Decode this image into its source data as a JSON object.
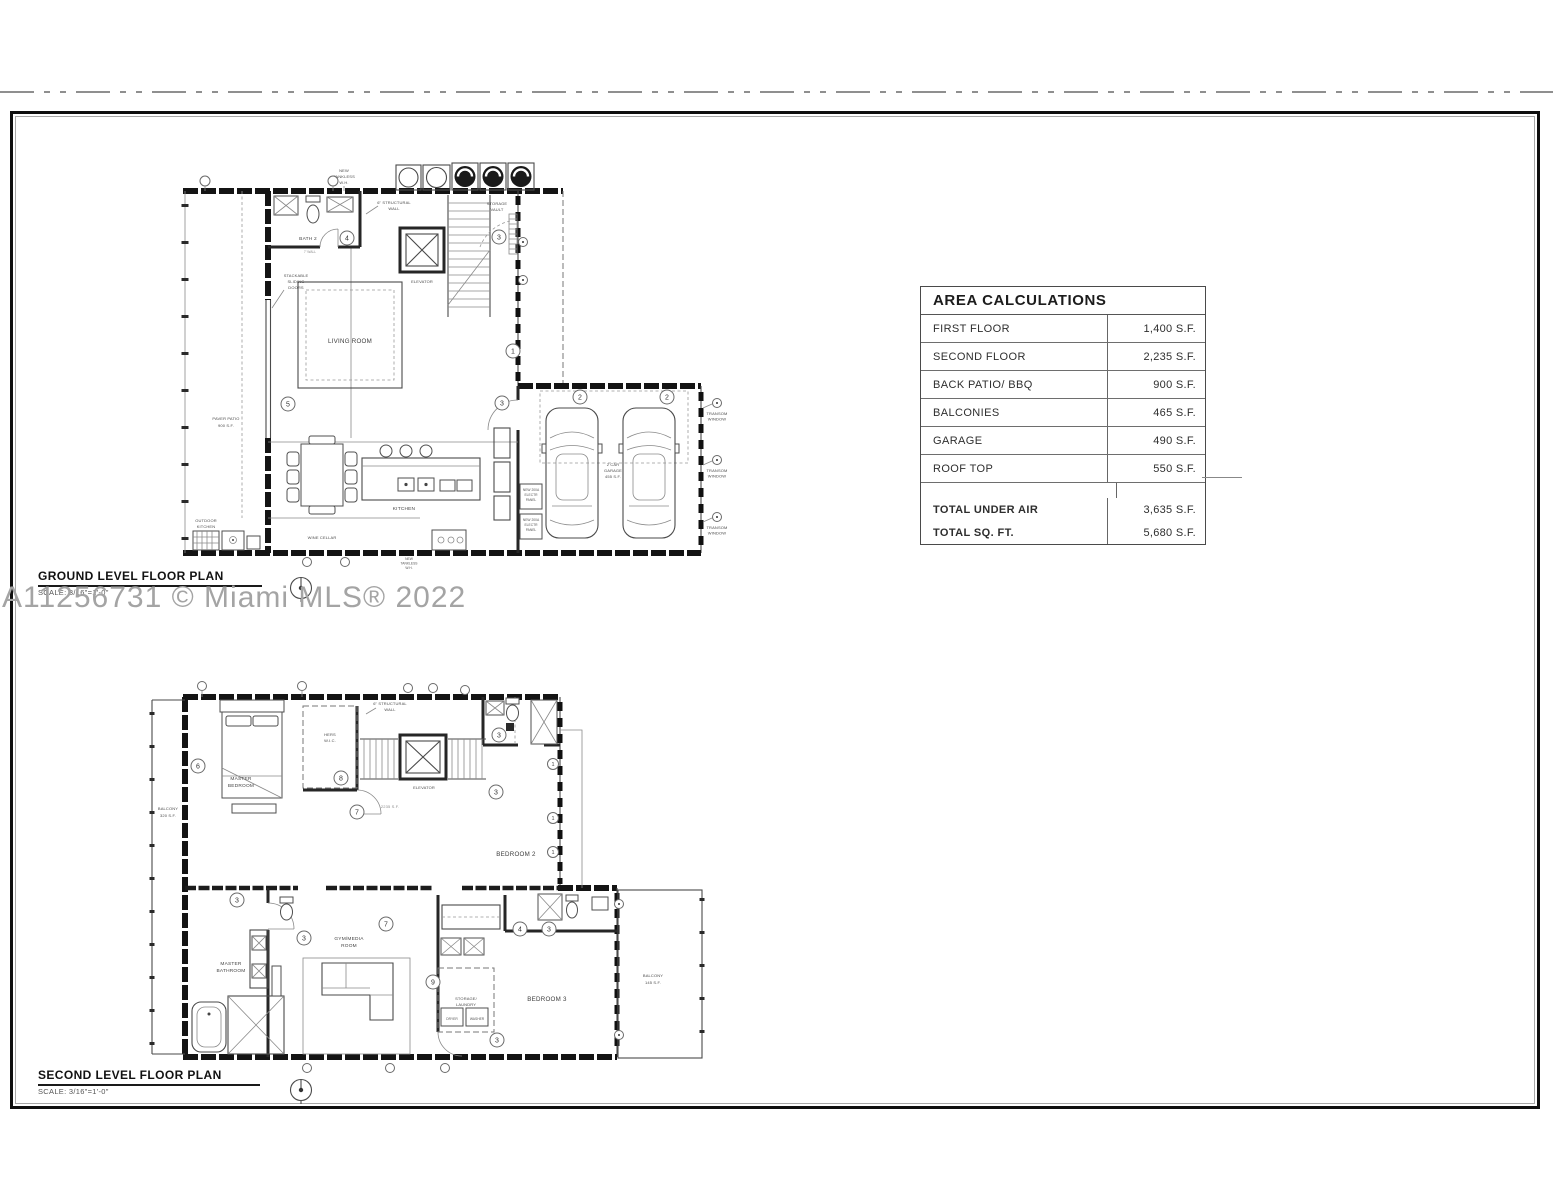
{
  "sheet": {
    "watermark": "A11256731 © Miami MLS® 2022"
  },
  "area_table": {
    "title": "AREA CALCULATIONS",
    "rows": [
      {
        "label": "FIRST FLOOR",
        "value": "1,400 S.F."
      },
      {
        "label": "SECOND FLOOR",
        "value": "2,235 S.F."
      },
      {
        "label": "BACK PATIO/ BBQ",
        "value": "900 S.F."
      },
      {
        "label": "BALCONIES",
        "value": "465 S.F."
      },
      {
        "label": "GARAGE",
        "value": "490 S.F."
      },
      {
        "label": "ROOF TOP",
        "value": "550 S.F."
      }
    ],
    "totals": [
      {
        "label": "TOTAL UNDER AIR",
        "value": "3,635 S.F."
      },
      {
        "label": "TOTAL SQ. FT.",
        "value": "5,680 S.F."
      }
    ]
  },
  "ground": {
    "title": "GROUND LEVEL FLOOR PLAN",
    "scale": "SCALE: 3/16\"=1'-0\"",
    "labels": {
      "bath": "BATH 2",
      "wall7": "7' WALL",
      "elevator": "ELEVATOR",
      "storage1": "STORAGE",
      "storage2": "VAULT",
      "living": "LIVING ROOM",
      "kitchen": "KITCHEN",
      "wine": "WINE CELLAR",
      "patio1": "PAVER PATIO",
      "patio2": "900 S.F.",
      "outdoor1": "OUTDOOR",
      "outdoor2": "KITCHEN",
      "garage1": "2 CAR",
      "garage2": "GARAGE",
      "garage3": "455 S.F.",
      "struct1": "6\" STRUCTURAL",
      "struct2": "WALL",
      "stack1": "STACKABLE",
      "stack2": "SLIDING",
      "stack3": "DOORS",
      "tank1": "NEW",
      "tank2": "TANKLESS",
      "tank3": "W.H.",
      "transom1": "TRANSOM",
      "transom2": "WINDOW",
      "panel1": "NEW 200A",
      "panel2": "ELECTR",
      "panel3": "PANEL"
    }
  },
  "second": {
    "title": "SECOND LEVEL FLOOR PLAN",
    "scale": "SCALE: 3/16\"=1'-0\"",
    "labels": {
      "master1": "MASTER",
      "master2": "BEDROOM",
      "wic1": "HERS",
      "wic2": "W.I.C.",
      "elevator": "ELEVATOR",
      "struct1": "6\" STRUCTURAL",
      "struct2": "WALL",
      "area": "2235 S.F.",
      "bedroom2": "BEDROOM 2",
      "bedroom3": "BEDROOM 3",
      "mbath1": "MASTER",
      "mbath2": "BATHROOM",
      "gym1": "GYM/MEDIA",
      "gym2": "ROOM",
      "laundry1": "STORAGE/",
      "laundry2": "LAUNDRY",
      "dryer": "DRYER",
      "washer": "WASHER",
      "balcl1": "BALCONY",
      "balcl2": "320 S.F.",
      "balcr1": "BALCONY",
      "balcr2": "145 S.F."
    }
  },
  "markers": {
    "n1": "1",
    "n2": "2",
    "n3": "3",
    "n4": "4",
    "n5": "5",
    "n6": "6",
    "n7": "7",
    "n8": "8",
    "n9": "9"
  }
}
